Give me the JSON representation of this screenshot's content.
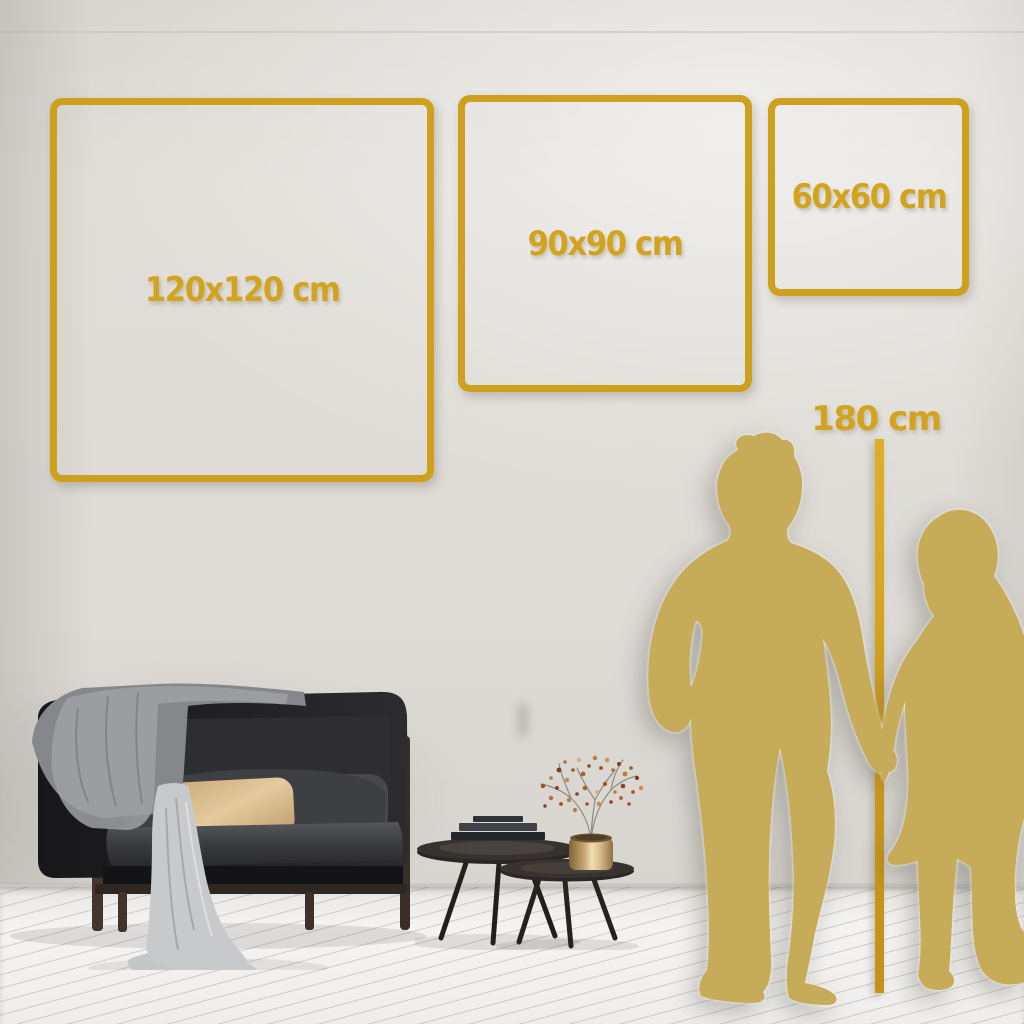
{
  "frames": [
    {
      "size": "large",
      "label": "120x120 cm"
    },
    {
      "size": "medium",
      "label": "90x90 cm"
    },
    {
      "size": "small",
      "label": "60x60 cm"
    }
  ],
  "height_marker": {
    "label": "180 cm"
  },
  "colors": {
    "accent_gold": "#CDA01D",
    "label_gold": "#D2A41E",
    "silhouette_gold": "#C6AC58",
    "wall": "#DEDBD6",
    "floor": "#F2F1EE"
  }
}
